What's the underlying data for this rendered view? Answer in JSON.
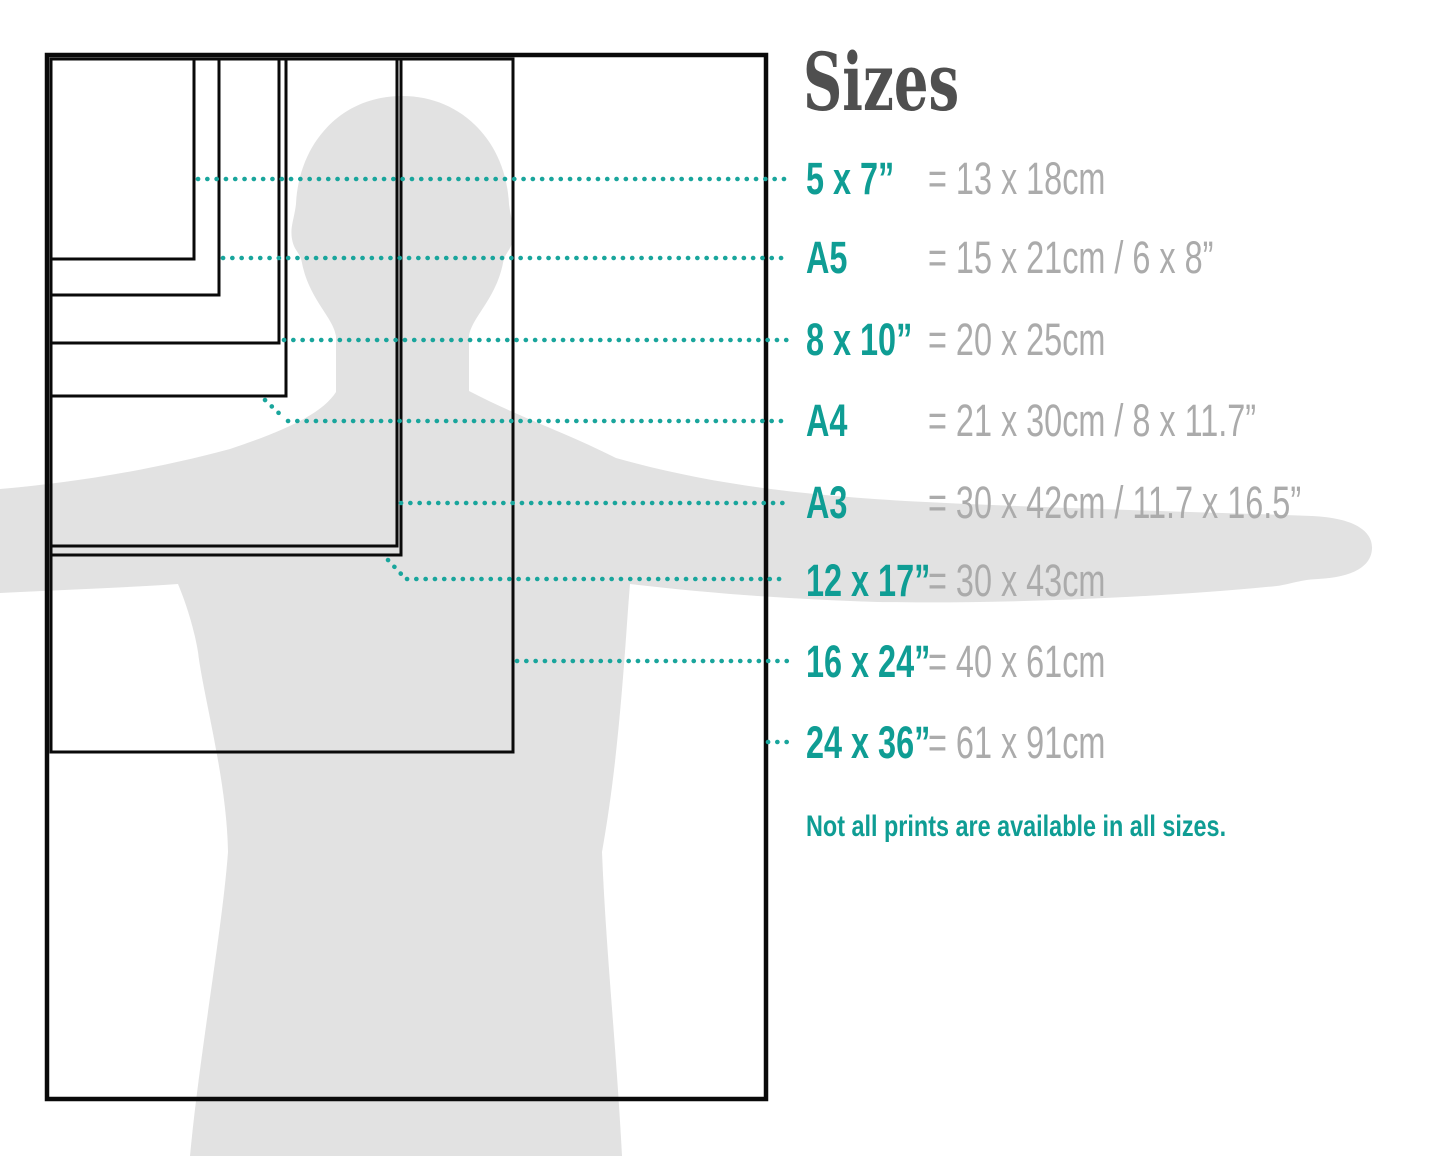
{
  "title": "Sizes",
  "footer_note": "Not all prints are available in all sizes.",
  "colors": {
    "teal": "#0F9D94",
    "dot_teal": "#19A59C",
    "value_gray": "#ABABAB",
    "title_gray": "#4F4F4F",
    "silhouette_gray": "#E2E2E2",
    "outline_black": "#0A0A0A"
  },
  "sizes": [
    {
      "id": "5x7",
      "label": "5 x 7”",
      "value": "= 13 x 18cm"
    },
    {
      "id": "a5",
      "label": "A5",
      "value": "= 15 x 21cm / 6 x 8”"
    },
    {
      "id": "8x10",
      "label": "8 x 10”",
      "value": "= 20 x 25cm"
    },
    {
      "id": "a4",
      "label": "A4",
      "value": "= 21 x 30cm / 8 x 11.7”"
    },
    {
      "id": "a3",
      "label": "A3",
      "value": "= 30 x 42cm / 11.7 x 16.5”"
    },
    {
      "id": "12x17",
      "label": "12 x 17”",
      "value": "= 30 x 43cm"
    },
    {
      "id": "16x24",
      "label": "16 x 24”",
      "value": "= 40 x 61cm"
    },
    {
      "id": "24x36",
      "label": "24 x 36”",
      "value": "= 61 x 91cm"
    }
  ]
}
